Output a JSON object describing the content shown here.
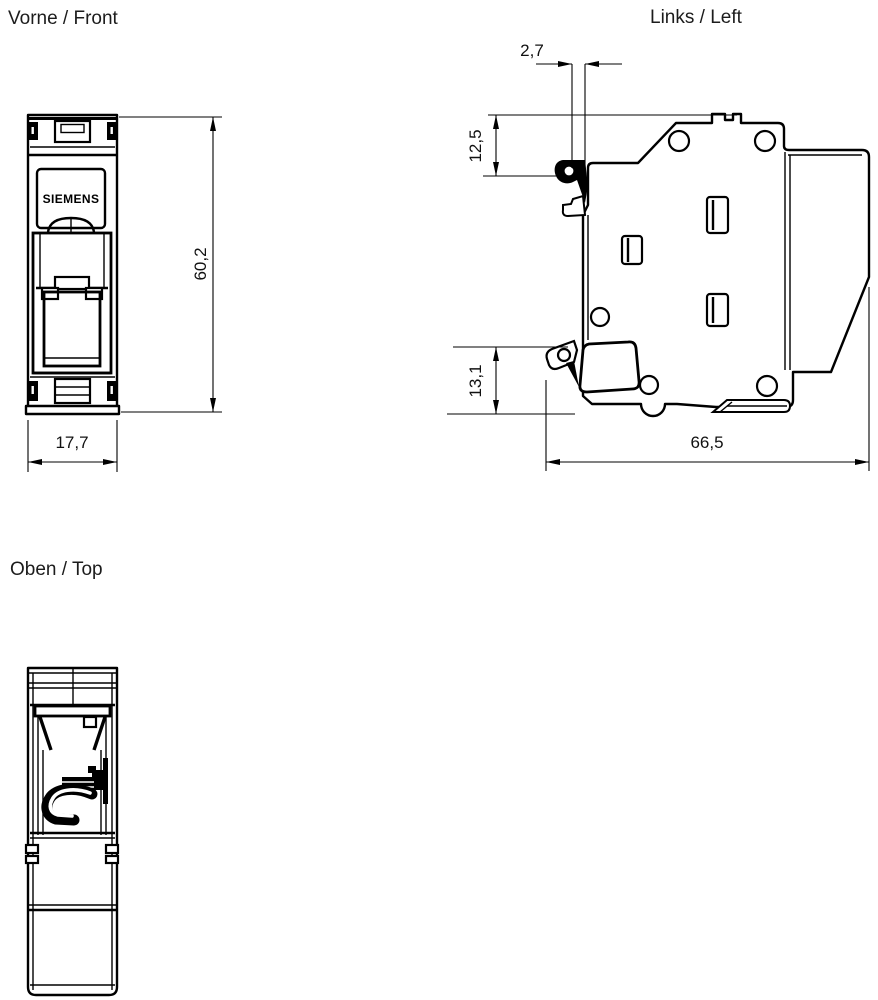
{
  "drawing": {
    "background": "#ffffff",
    "line_color": "#000000",
    "text_color": "#1c1c1c",
    "views": {
      "front": {
        "title": "Vorne / Front",
        "brand_label": "SIEMENS",
        "dimensions": {
          "height": "60,2",
          "width": "17,7"
        }
      },
      "left": {
        "title": "Links / Left",
        "dimensions": {
          "latch_offset": "2,7",
          "top_to_rail": "12,5",
          "clip_height": "13,1",
          "depth": "66,5"
        }
      },
      "top": {
        "title": "Oben / Top"
      }
    }
  }
}
